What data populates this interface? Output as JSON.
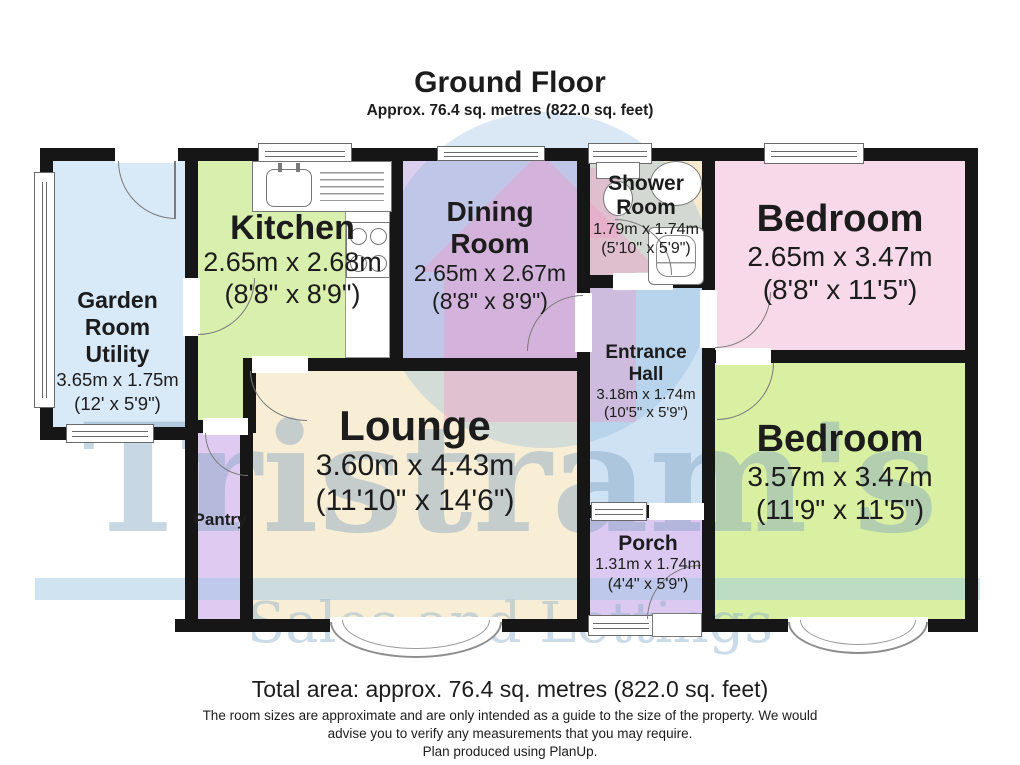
{
  "title": {
    "heading": "Ground Floor",
    "subheading": "Approx. 76.4 sq. metres (822.0 sq. feet)"
  },
  "rooms": {
    "garden": {
      "line1": "Garden",
      "line2": "Room",
      "line3": "Utility",
      "metric": "3.65m x 1.75m",
      "imperial": "(12' x 5'9\")",
      "color": "#d8e9f8"
    },
    "kitchen": {
      "name": "Kitchen",
      "metric": "2.65m x 2.68m",
      "imperial": "(8'8\" x 8'9\")",
      "color": "#d9efad"
    },
    "dining": {
      "line1": "Dining",
      "line2": "Room",
      "metric": "2.65m x 2.67m",
      "imperial": "(8'8\" x 8'9\")",
      "color": "#dbcfee"
    },
    "shower": {
      "line1": "Shower",
      "line2": "Room",
      "metric": "1.79m x 1.74m",
      "imperial": "(5'10\" x 5'9\")",
      "color": "#f6e9cf"
    },
    "bedroom1": {
      "name": "Bedroom",
      "metric": "2.65m x 3.47m",
      "imperial": "(8'8\" x 11'5\")",
      "color": "#f8d9e9"
    },
    "hall": {
      "line1": "Entrance",
      "line2": "Hall",
      "metric": "3.18m x 1.74m",
      "imperial": "(10'5\" x 5'9\")",
      "color": "#cfe2f4"
    },
    "bedroom2": {
      "name": "Bedroom",
      "metric": "3.57m x 3.47m",
      "imperial": "(11'9\" x 11'5\")",
      "color": "#d9f0a2"
    },
    "lounge": {
      "name": "Lounge",
      "metric": "3.60m x 4.43m",
      "imperial": "(11'10\" x 14'6\")",
      "color": "#f8eed6"
    },
    "pantry": {
      "name": "Pantry",
      "color": "#dfcbf2"
    },
    "porch": {
      "name": "Porch",
      "metric": "1.31m x 1.74m",
      "imperial": "(4'4\" x 5'9\")",
      "color": "#dcc9f1"
    }
  },
  "watermark": {
    "name": "Tristram's",
    "tagline": "Sales and Lettings"
  },
  "footer": {
    "total_area": "Total area: approx. 76.4 sq. metres (822.0 sq. feet)",
    "disclaimer_line1": "The room sizes are approximate and are only intended as a guide to the size of the property. We would",
    "disclaimer_line2": "advise you to verify any measurements that you may require.",
    "disclaimer_line3": "Plan produced using PlanUp."
  },
  "colors": {
    "wall": "#161616",
    "watermark_circle": "rgba(130,180,220,0.30)",
    "watermark_house": "rgba(243,150,198,0.38)",
    "watermark_band": "rgba(160,200,228,0.50)",
    "watermark_text": "rgba(125,160,190,0.42)",
    "watermark_text2": "rgba(140,175,205,0.45)"
  },
  "fixtures": {
    "sink": "sink-icon",
    "hob": "hob-icon",
    "toilet": "toilet-icon",
    "basin": "basin-icon",
    "shower": "shower-icon"
  }
}
